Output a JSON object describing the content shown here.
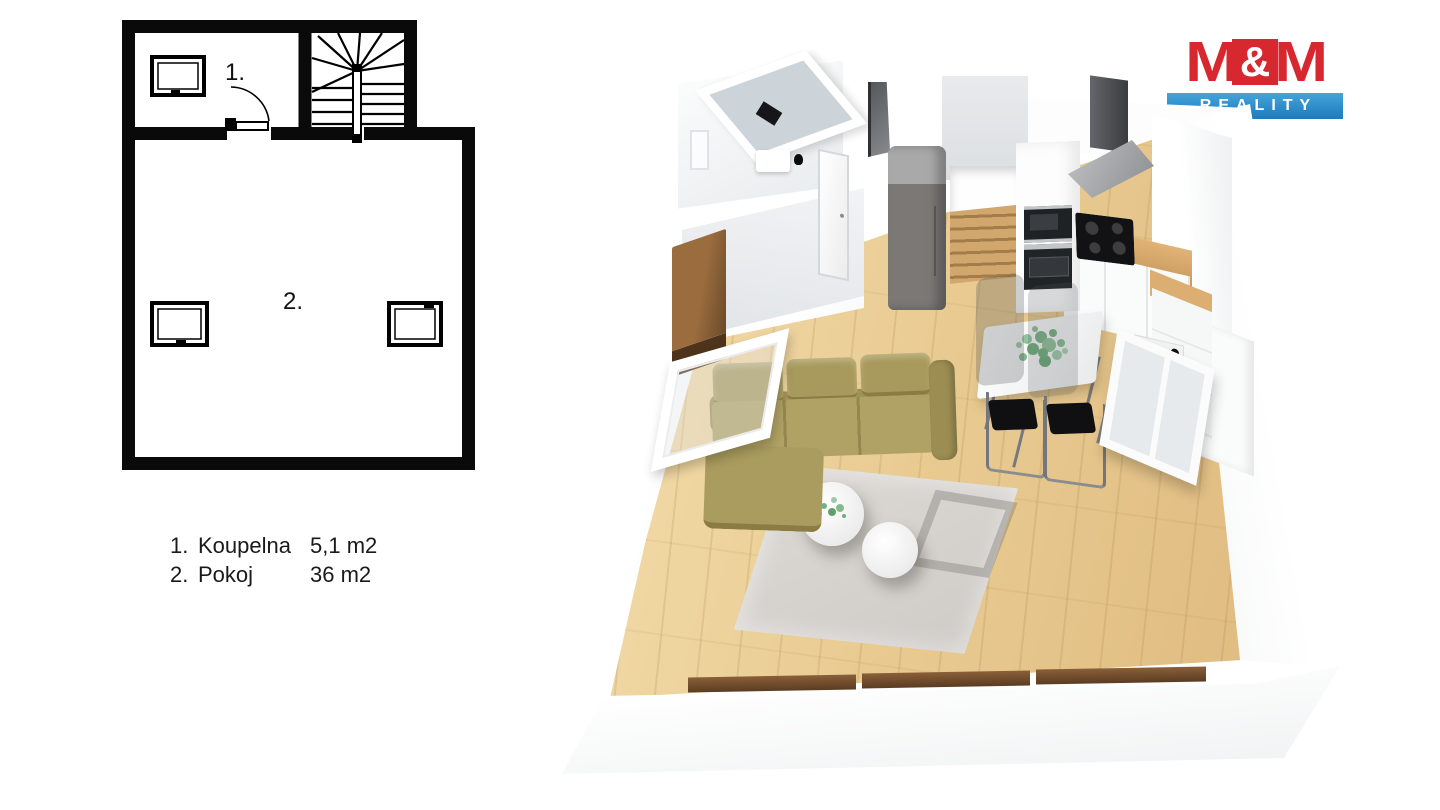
{
  "logo": {
    "m_left": "M",
    "ampersand": "&",
    "m_right": "M",
    "banner": "REALITY",
    "red": "#d7282f",
    "blue": "#1f80c0"
  },
  "plan2d": {
    "room1_label": "1.",
    "room2_label": "2."
  },
  "legend": {
    "rows": [
      {
        "num": "1.",
        "name": "Koupelna",
        "area": "5,1 m2"
      },
      {
        "num": "2.",
        "name": "Pokoj",
        "area": "36 m2"
      }
    ]
  },
  "plan3d": {
    "colors": {
      "floor_wood": "#ecd09e",
      "wall_white": "#ffffff",
      "wall_shade": "#edeff0",
      "sofa_olive": "#a89a5c",
      "rug_gray": "#d8d5d1",
      "sideboard_walnut": "#7b5733",
      "fridge_gray": "#7b7876",
      "counter_wood": "#d8aa6e",
      "stairs_wood": "#c59a63",
      "appliance_black": "#1f2224",
      "steel": "#c3c6c9",
      "plant_green": "#7fb98c"
    }
  }
}
